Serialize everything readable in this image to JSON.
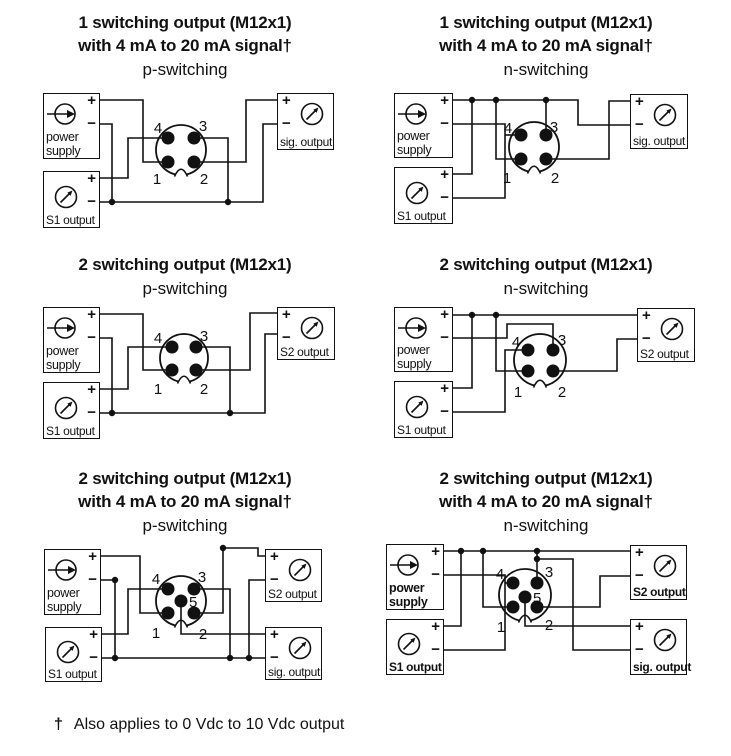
{
  "symbols": {
    "plus": "+",
    "minus": "−"
  },
  "footnote": {
    "dagger": "†",
    "text": "Also applies to 0 Vdc to 10 Vdc output"
  },
  "diagrams": [
    {
      "title_line1": "1 switching output (M12x1)",
      "title_line2": "with 4 mA to 20 mA signal†",
      "subtitle": "p-switching",
      "boxes": [
        {
          "label": "power supply"
        },
        {
          "label": "S1 output"
        },
        {
          "label": "sig. output"
        }
      ],
      "pins": [
        "4",
        "3",
        "1",
        "2"
      ]
    },
    {
      "title_line1": "1 switching output (M12x1)",
      "title_line2": "with 4 mA to 20 mA signal†",
      "subtitle": "n-switching",
      "boxes": [
        {
          "label": "power supply"
        },
        {
          "label": "S1 output"
        },
        {
          "label": "sig. output"
        }
      ],
      "pins": [
        "4",
        "3",
        "1",
        "2"
      ]
    },
    {
      "title_line1": "2 switching output (M12x1)",
      "subtitle": "p-switching",
      "boxes": [
        {
          "label": "power supply"
        },
        {
          "label": "S1 output"
        },
        {
          "label": "S2 output"
        }
      ],
      "pins": [
        "4",
        "3",
        "1",
        "2"
      ]
    },
    {
      "title_line1": "2 switching output (M12x1)",
      "subtitle": "n-switching",
      "boxes": [
        {
          "label": "power supply"
        },
        {
          "label": "S1 output"
        },
        {
          "label": "S2 output"
        }
      ],
      "pins": [
        "4",
        "3",
        "1",
        "2"
      ]
    },
    {
      "title_line1": "2 switching output (M12x1)",
      "title_line2": "with 4 mA to 20 mA signal†",
      "subtitle": "p-switching",
      "boxes": [
        {
          "label": "power supply"
        },
        {
          "label": "S1 output"
        },
        {
          "label": "S2 output"
        },
        {
          "label": "sig. output"
        }
      ],
      "pins": [
        "4",
        "3",
        "5",
        "1",
        "2"
      ]
    },
    {
      "title_line1": "2 switching output (M12x1)",
      "title_line2": "with 4 mA to 20 mA signal†",
      "subtitle": "n-switching",
      "boxes": [
        {
          "label": "power supply"
        },
        {
          "label": "S1 output"
        },
        {
          "label": "S2 output"
        },
        {
          "label": "sig. output"
        }
      ],
      "pins": [
        "4",
        "3",
        "5",
        "1",
        "2"
      ]
    }
  ]
}
